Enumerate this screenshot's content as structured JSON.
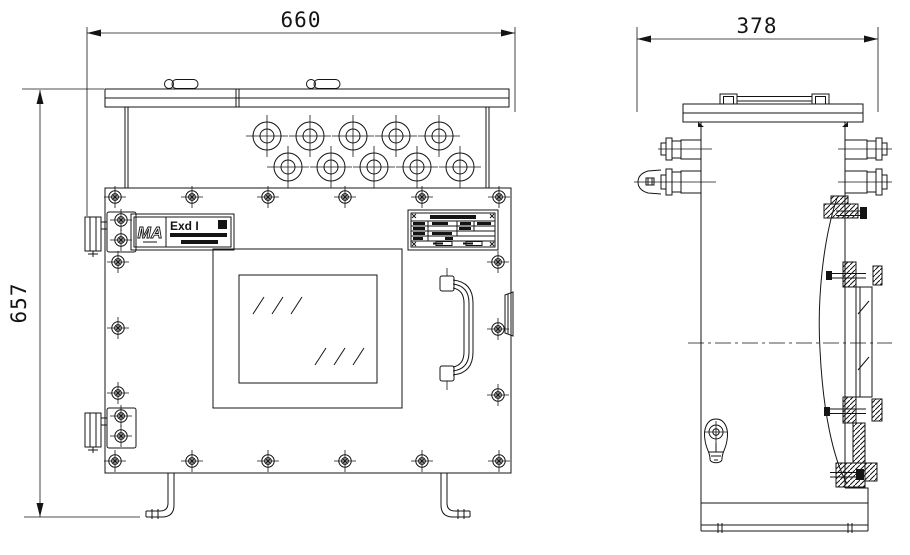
{
  "page": {
    "background": "#ffffff",
    "line_color": "#141414"
  },
  "drawing": {
    "type": "engineering-drawing",
    "subject": "flameproof-enclosure-two-views",
    "dimensions": {
      "overall_width_mm": "660",
      "overall_height_mm": "657",
      "overall_depth_mm": "378"
    },
    "certification_plate": {
      "logo_text": "MA",
      "marking_text": "Exd I"
    }
  }
}
